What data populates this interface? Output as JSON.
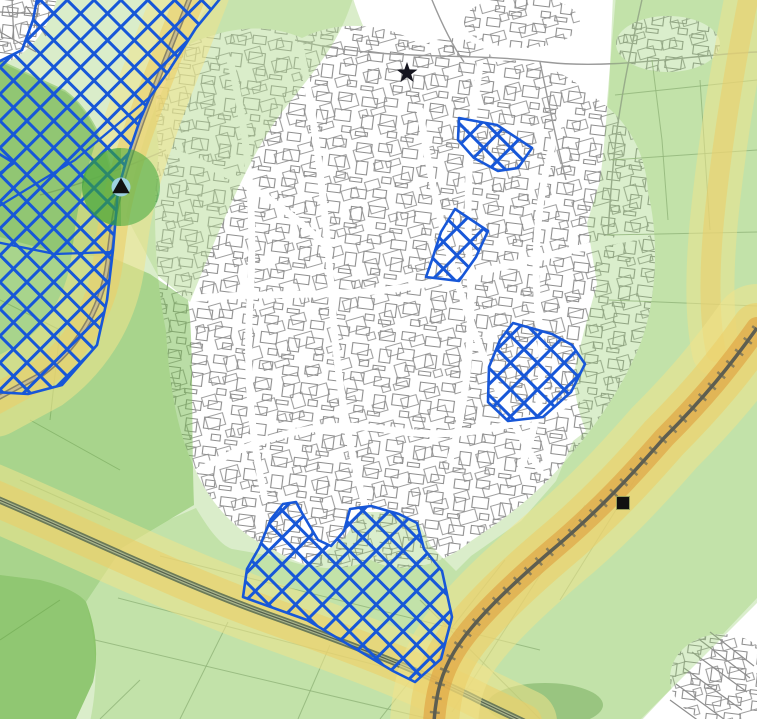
{
  "map": {
    "width": 757,
    "height": 719,
    "palette": {
      "background": "#ffffff",
      "site_blue": "#1757d8",
      "street_gray": "#8e8e8e",
      "lane_gray": "#9a9a9a",
      "field_green_line": "#8da57e",
      "rural_green": "rgba(172,214,138,0.45)",
      "marker_black": "#111111"
    },
    "patterns": {
      "hatch": {
        "size": 19,
        "rotate": 45,
        "stroke": "#1757d8",
        "width": 3
      },
      "blocks": [
        {
          "id": "blocks1",
          "size": 46,
          "rotate": 7,
          "d": "M4,6 h15 v9 h-15 z M26,4 h13 v8 h-13 z M6,24 h11 v13 h-11 z M24,21 h16 v11 h-16 z M1,41 h12 v4 h-12 z M33,37 h9 v6 h-9 z",
          "stroke": "#8e8e8e",
          "width": 1.1
        },
        {
          "id": "blocks2",
          "size": 54,
          "rotate": -16,
          "d": "M5,8 h16 v10 h-16 z M30,6 h14 v9 h-14 z M8,28 h12 v14 h-12 z M28,26 h18 v12 h-18 z M44,44 h8 v7 h-8 z M2,46 h14 v6 h-14 z",
          "stroke": "#8e8e8e",
          "width": 1.1
        }
      ]
    },
    "urban": {
      "town_blob": "M165,58 C210,28 262,20 302,38 C340,18 392,24 422,46 C450,30 482,40 496,62 C532,54 572,76 592,96 C626,116 646,152 648,192 C660,242 656,302 641,342 C621,392 591,432 561,466 C531,500 501,521 471,541 C441,566 401,576 371,560 C331,576 301,566 276,551 C241,536 211,506 196,471 C176,431 169,381 166,331 C156,281 151,211 159,151 C153,111 156,81 165,58 Z",
      "nw_corner_blob": "M-5,-5 L58,-5 C50,25 36,46 12,60 L-5,64 Z",
      "white_top_patch": "M352,-5 L616,-5 L608,90 C604,140 600,180 598,235 L540,200 C500,175 460,135 420,100 C395,80 370,55 352,-5 Z",
      "se_white_triangle": "M640,722 L757,598 L757,722 Z",
      "village_ellipses": [
        {
          "cx": 522,
          "cy": 22,
          "rx": 58,
          "ry": 26
        },
        {
          "cx": 668,
          "cy": 44,
          "rx": 52,
          "ry": 28
        },
        {
          "cx": 722,
          "cy": 678,
          "rx": 52,
          "ry": 44
        }
      ],
      "white_roads": [
        "M180,300 C260,290 340,300 420,285 C490,272 560,250 645,235",
        "M300,45 C315,120 325,200 332,300 C338,400 355,480 380,555",
        "M200,470 C270,430 330,420 390,430 C450,440 520,430 585,395",
        "M480,65 C470,130 465,200 470,270 C473,330 468,400 450,460",
        "M165,150 C230,170 280,200 330,250",
        "M560,120 C540,180 530,250 540,330 C545,380 540,420 520,470",
        "M230,60 C250,140 255,220 250,300 C246,370 250,430 265,500",
        "M420,110 C430,180 445,250 470,320 C490,375 510,420 540,470"
      ],
      "white_road_width": 7
    },
    "rural_lines": {
      "lanes": [
        "M295,40 C380,62 470,52 545,62 C612,70 690,55 757,52",
        "M430,-5 C442,25 452,45 464,62",
        "M643,-5 C633,40 624,80 617,130 C612,170 610,200 608,235",
        "M540,62 C548,100 556,140 566,180",
        "M166,150 C120,170 80,185 40,195"
      ],
      "fields": [
        "M615,95 L757,80",
        "M612,160 L757,150",
        "M607,235 L757,232",
        "M609,300 L757,306",
        "M652,60 L662,140 L668,220",
        "M700,80 L710,230",
        "M95,640 L430,719",
        "M118,598 L480,692",
        "M160,556 L540,650",
        "M505,560 L380,719",
        "M585,505 L452,712",
        "M650,455 L560,600",
        "M228,622 L180,719",
        "M330,645 L298,719",
        "M420,600 L540,719",
        "M60,600 L0,640",
        "M140,680 L100,719",
        "M30,420 L120,470",
        "M20,480 L110,520",
        "M0,300 L60,330",
        "M60,330 L50,420"
      ],
      "se_buildings": [
        "M692,652 l55,40",
        "M700,640 l50,38",
        "M684,668 l58,42",
        "M710,632 l44,34",
        "M676,684 l60,44",
        "M670,700 l55,40"
      ],
      "nw_streets": [
        "M0,12 L40,14",
        "M12,-2 L14,44",
        "M26,6 L46,36",
        "M0,32 L36,52",
        "M40,-2 L34,28"
      ],
      "woods": {
        "cx": 545,
        "cy": 705,
        "rx": 58,
        "ry": 22,
        "fill": "rgba(80,140,60,0.45)"
      }
    },
    "tints": [
      {
        "name": "green-tint-northwest-wedge",
        "d": "M216,-5 L354,-5 C340,40 325,58 282,112 C250,155 225,215 190,302 L158,276 L126,216 C135,165 148,118 172,70 C186,42 200,15 216,-5 Z",
        "fill": "rgba(172,214,138,0.45)"
      },
      {
        "name": "green-tint-west",
        "d": "M0,60 L65,90 C90,108 105,140 112,172 C118,200 116,230 113,258 L150,274 L188,300 C194,340 191,420 194,505 L162,524 L122,548 L86,602 C96,628 99,655 93,682 L76,719 L0,719 Z",
        "fill": "rgba(118,188,78,0.50)"
      },
      {
        "name": "green-tint-west-dark",
        "d": "M0,62 L65,92 C92,112 106,146 116,196 C118,226 115,244 112,258 L55,252 L0,237 Z",
        "fill": "rgba(92,166,60,0.30)"
      },
      {
        "name": "green-tint-east",
        "d": "M613,-5 L762,-5 L762,598 L638,722 L90,722 C97,688 99,652 86,602 L122,548 L168,520 L196,508 C208,528 220,545 232,549 L272,556 L306,566 L346,536 L361,512 L391,512 L419,523 L431,546 L456,571 L471,556 L521,521 L556,481 L573,441 L586,431 C578,412 574,392 574,372 L584,331 L597,284 L587,223 L600,181 C604,150 606,120 609,90 Z",
        "fill": "rgba(150,205,110,0.35)"
      },
      {
        "name": "green-tint-southwest-arc",
        "d": "M0,575 L40,580 C60,585 78,592 86,602 C96,628 99,655 93,682 L76,719 L0,719 Z",
        "fill": "rgba(100,175,65,0.35)"
      }
    ],
    "corridors": [
      {
        "name": "road-buffer-northwest",
        "path": "M193,-10 C172,45 140,118 122,183 C113,216 111,240 108,262 C101,315 72,352 42,374 L-6,400",
        "bands": [
          {
            "color": "rgba(240,228,140,0.55)",
            "width": 74
          },
          {
            "color": "rgba(235,206,105,0.60)",
            "width": 30
          }
        ],
        "lines": [
          {
            "color": "#8a8468",
            "width": 5.5
          },
          {
            "color": "#c9bd8e",
            "width": 2.5
          }
        ]
      },
      {
        "name": "road-buffer-southwest",
        "path": "M-10,496 C80,534 180,584 280,619 C352,645 422,671 482,702 L524,722",
        "bands": [
          {
            "color": "rgba(240,228,140,0.55)",
            "width": 66
          },
          {
            "color": "rgba(235,206,105,0.60)",
            "width": 36
          }
        ],
        "lines": [
          {
            "color": "#6b7a58",
            "width": 7
          },
          {
            "color": "#a9b58e",
            "width": 3.5
          },
          {
            "color": "#55604a",
            "width": 1.2
          }
        ]
      },
      {
        "name": "railway-buffer-upper-east",
        "path": "M750,-10 C736,60 722,140 714,220 C709,272 709,320 716,352",
        "bands": [
          {
            "color": "rgba(240,228,140,0.50)",
            "width": 48
          },
          {
            "color": "rgba(235,206,105,0.55)",
            "width": 20
          }
        ],
        "lines": []
      },
      {
        "name": "railway-buffer-main",
        "path": "M757,328 C730,366 704,398 664,438 C636,470 600,510 552,550 C510,586 472,622 454,652 C442,672 436,692 434,722",
        "bands": [
          {
            "color": "rgba(240,228,140,0.55)",
            "width": 88
          },
          {
            "color": "rgba(235,206,105,0.60)",
            "width": 50
          },
          {
            "color": "rgba(224,166,70,0.70)",
            "width": 22
          }
        ],
        "lines": [
          {
            "color": "#6c6c5a",
            "width": 10,
            "dash": "2.5 12",
            "opacity": 0.75
          },
          {
            "color": "#5e5e50",
            "width": 3.5
          }
        ]
      }
    ],
    "allocations": {
      "stroke": "#1757d8",
      "stroke_width": 2.6,
      "polygons": [
        {
          "name": "hatched-site-northwest",
          "d": "M38,-6 L224,-6 L196,28 L168,72 L150,97 L140,120 L127,158 L118,190 L113,250 L107,300 L97,345 L62,385 L28,394 L-6,392 L-6,64 L22,50 L33,20 Z"
        },
        {
          "name": "hatched-site-north",
          "d": "M459,118 L497,125 L532,148 L518,168 L498,171 L474,158 L458,140 Z"
        },
        {
          "name": "hatched-site-central",
          "d": "M455,209 L488,231 L476,257 L459,281 L426,277 L432,260 L441,232 Z"
        },
        {
          "name": "hatched-site-east",
          "d": "M513,323 L552,334 L572,345 L585,364 L571,392 L543,417 L508,421 L488,402 L489,367 L500,340 Z"
        },
        {
          "name": "hatched-site-south",
          "d": "M283,504 L296,502 L302,513 L318,540 L331,546 L344,531 L350,509 L371,506 L399,514 L417,523 L424,549 L442,571 L452,617 L441,659 L415,682 L393,671 L307,620 L243,597 L247,569 L259,548 L271,519 Z"
        },
        {
          "name": "hatched-site-west-edge",
          "d": "M-4,152 L14,163 L-4,176 Z"
        }
      ],
      "inner_boundaries": [
        "M150,97 L75,160 L-4,208",
        "M113,252 L55,254 L-4,242"
      ]
    },
    "markers": {
      "buffer_circle": {
        "cx": 121,
        "cy": 187,
        "r": 39,
        "fill": "rgba(62,168,62,0.55)",
        "half_shade": "M121,148 A39,39 0 0 0 121,226 Z",
        "half_shade_fill": "rgba(40,150,40,0.25)",
        "inner_r": 9.5,
        "inner_fill": "#9ed2e0",
        "triangle_color": "#111111",
        "triangle_size": 15
      },
      "star": {
        "cx": 407,
        "cy": 73,
        "r_outer": 11,
        "r_inner": 4.4,
        "fill": "#14141e"
      },
      "square": {
        "cx": 623,
        "cy": 503,
        "size": 13,
        "fill": "#111111",
        "stroke": "#9aa05a",
        "stroke_width": 1
      }
    }
  }
}
